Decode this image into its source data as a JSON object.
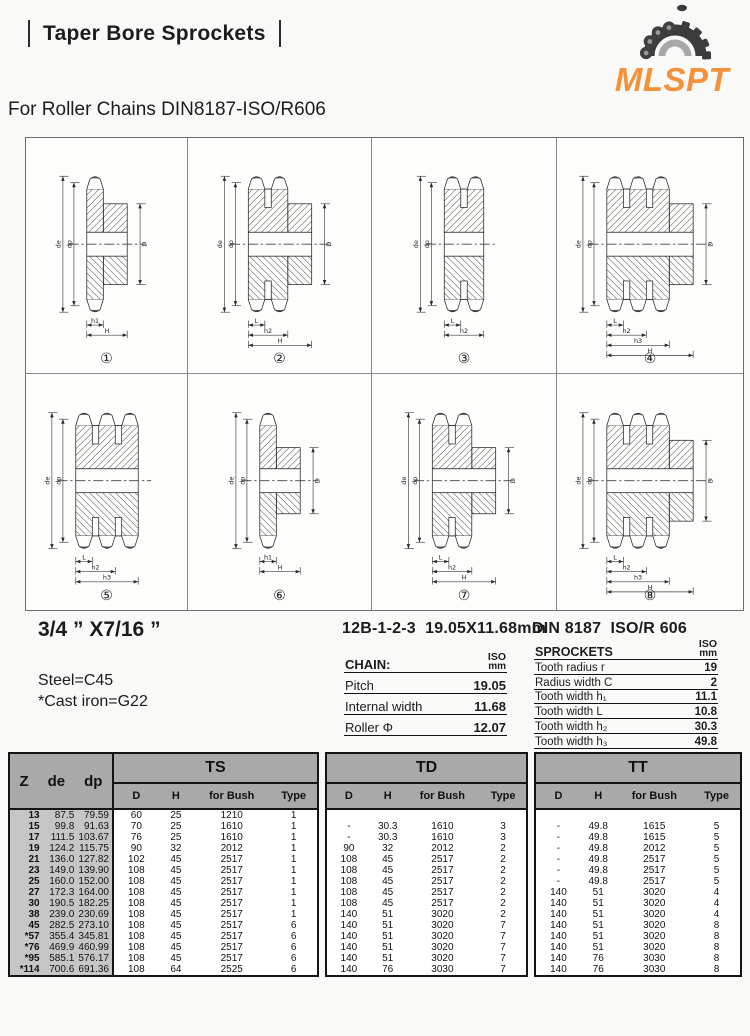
{
  "page": {
    "title": "Taper Bore Sprockets",
    "subtitle": "For Roller Chains DIN8187-ISO/R606",
    "logo_text": "MLSPT",
    "logo_color": "#F2923A"
  },
  "specs": {
    "size_label": "3/4 ” X7/16 ”",
    "material_line1": "Steel=C45",
    "material_line2": "*Cast iron=G22",
    "chain_title": "12B-1-2-3  19.05X11.68mm",
    "sprocket_title": "DIN 8187  ISO/R 606",
    "unit_top": "ISO",
    "unit_bottom": "mm",
    "chain_table": {
      "header": "CHAIN:",
      "rows": [
        [
          "Pitch",
          "19.05"
        ],
        [
          "Internal width",
          "11.68"
        ],
        [
          "Roller Φ",
          "12.07"
        ]
      ]
    },
    "sprocket_table": {
      "header": "SPROCKETS",
      "rows": [
        [
          "Tooth radius r",
          "19"
        ],
        [
          "Radius width C",
          "2"
        ],
        [
          "Tooth width h₁",
          "11.1"
        ],
        [
          "Tooth width L",
          "10.8"
        ],
        [
          "Tooth width h₂",
          "30.3"
        ],
        [
          "Tooth width h₃",
          "49.8"
        ]
      ]
    }
  },
  "diagram_labels": {
    "left": [
      "de",
      "dp"
    ],
    "right": "D"
  },
  "diagrams": [
    {
      "num": "①",
      "tooth_rows": 1,
      "hub": true,
      "hub_small": false,
      "dims": [
        "h1",
        "H"
      ],
      "d_label": true
    },
    {
      "num": "②",
      "tooth_rows": 2,
      "hub": true,
      "hub_small": false,
      "dims": [
        "L",
        "h2",
        "H"
      ],
      "d_label": true
    },
    {
      "num": "③",
      "tooth_rows": 2,
      "hub": false,
      "hub_small": false,
      "dims": [
        "L",
        "h2"
      ],
      "d_label": false
    },
    {
      "num": "④",
      "tooth_rows": 3,
      "hub": true,
      "hub_small": false,
      "dims": [
        "L",
        "h2",
        "h3",
        "H"
      ],
      "d_label": true
    },
    {
      "num": "⑤",
      "tooth_rows": 3,
      "hub": false,
      "hub_small": false,
      "dims": [
        "L",
        "h2",
        "h3"
      ],
      "d_label": false
    },
    {
      "num": "⑥",
      "tooth_rows": 1,
      "hub": true,
      "hub_small": true,
      "dims": [
        "h1",
        "H"
      ],
      "d_label": true
    },
    {
      "num": "⑦",
      "tooth_rows": 2,
      "hub": true,
      "hub_small": true,
      "dims": [
        "L",
        "h2",
        "H"
      ],
      "d_label": true
    },
    {
      "num": "⑧",
      "tooth_rows": 3,
      "hub": true,
      "hub_small": false,
      "dims": [
        "L",
        "h2",
        "h3",
        "H"
      ],
      "d_label": true
    }
  ],
  "main_table": {
    "corner_headers": [
      "Z",
      "de",
      "dp"
    ],
    "groups": [
      "TS",
      "TD",
      "TT"
    ],
    "sub_headers": [
      "D",
      "H",
      "for Bush",
      "Type"
    ],
    "rows": [
      [
        "13",
        "87.5",
        "79.59",
        "60",
        "25",
        "1210",
        "1",
        "",
        "",
        "",
        "",
        "",
        "",
        "",
        ""
      ],
      [
        "15",
        "99.8",
        "91.63",
        "70",
        "25",
        "1610",
        "1",
        "-",
        "30.3",
        "1610",
        "3",
        "-",
        "49.8",
        "1615",
        "5"
      ],
      [
        "17",
        "111.5",
        "103.67",
        "76",
        "25",
        "1610",
        "1",
        "-",
        "30.3",
        "1610",
        "3",
        "-",
        "49.8",
        "1615",
        "5"
      ],
      [
        "19",
        "124.2",
        "115.75",
        "90",
        "32",
        "2012",
        "1",
        "90",
        "32",
        "2012",
        "2",
        "-",
        "49.8",
        "2012",
        "5"
      ],
      [
        "21",
        "136.0",
        "127.82",
        "102",
        "45",
        "2517",
        "1",
        "108",
        "45",
        "2517",
        "2",
        "-",
        "49.8",
        "2517",
        "5"
      ],
      [
        "23",
        "149.0",
        "139.90",
        "108",
        "45",
        "2517",
        "1",
        "108",
        "45",
        "2517",
        "2",
        "-",
        "49.8",
        "2517",
        "5"
      ],
      [
        "25",
        "160.0",
        "152.00",
        "108",
        "45",
        "2517",
        "1",
        "108",
        "45",
        "2517",
        "2",
        "-",
        "49.8",
        "2517",
        "5"
      ],
      [
        "27",
        "172.3",
        "164.00",
        "108",
        "45",
        "2517",
        "1",
        "108",
        "45",
        "2517",
        "2",
        "140",
        "51",
        "3020",
        "4"
      ],
      [
        "30",
        "190.5",
        "182.25",
        "108",
        "45",
        "2517",
        "1",
        "108",
        "45",
        "2517",
        "2",
        "140",
        "51",
        "3020",
        "4"
      ],
      [
        "38",
        "239.0",
        "230.69",
        "108",
        "45",
        "2517",
        "1",
        "140",
        "51",
        "3020",
        "2",
        "140",
        "51",
        "3020",
        "4"
      ],
      [
        "45",
        "282.5",
        "273.10",
        "108",
        "45",
        "2517",
        "6",
        "140",
        "51",
        "3020",
        "7",
        "140",
        "51",
        "3020",
        "8"
      ],
      [
        "*57",
        "355.4",
        "345.81",
        "108",
        "45",
        "2517",
        "6",
        "140",
        "51",
        "3020",
        "7",
        "140",
        "51",
        "3020",
        "8"
      ],
      [
        "*76",
        "469.9",
        "460.99",
        "108",
        "45",
        "2517",
        "6",
        "140",
        "51",
        "3020",
        "7",
        "140",
        "51",
        "3020",
        "8"
      ],
      [
        "*95",
        "585.1",
        "576.17",
        "108",
        "45",
        "2517",
        "6",
        "140",
        "51",
        "3020",
        "7",
        "140",
        "76",
        "3030",
        "8"
      ],
      [
        "*114",
        "700.6",
        "691.36",
        "108",
        "64",
        "2525",
        "6",
        "140",
        "76",
        "3030",
        "7",
        "140",
        "76",
        "3030",
        "8"
      ]
    ]
  }
}
